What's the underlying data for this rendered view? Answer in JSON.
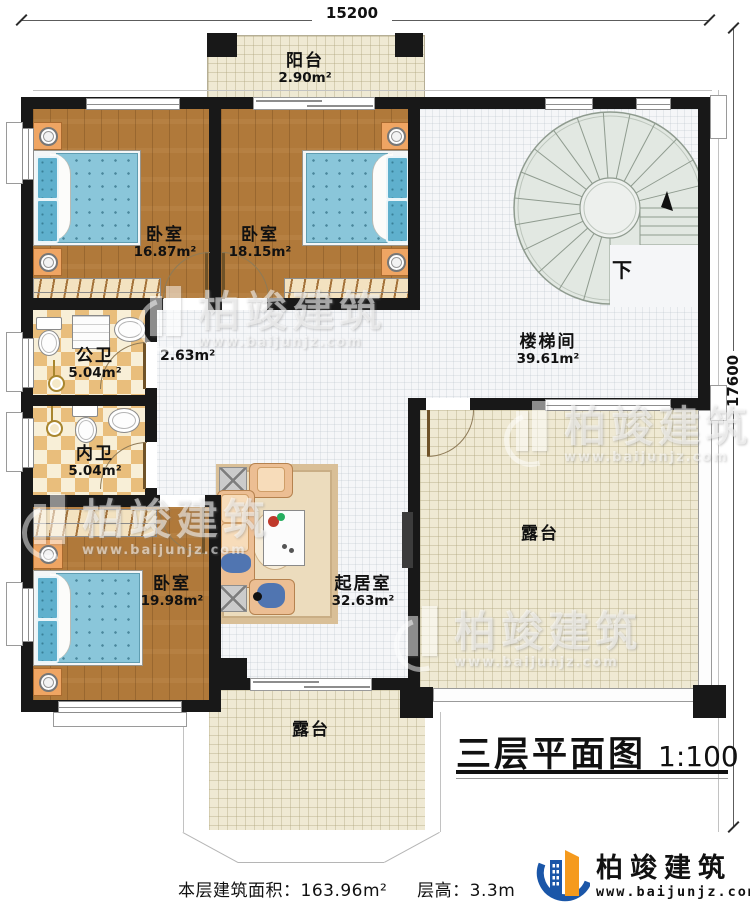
{
  "dimensions": {
    "top": "15200",
    "right": "17600"
  },
  "rooms": [
    {
      "name": "阳台",
      "area": "2.90m²"
    },
    {
      "name": "卧室",
      "area": "16.87m²"
    },
    {
      "name": "卧室",
      "area": "18.15m²"
    },
    {
      "name": "楼梯间",
      "area": "39.61m²"
    },
    {
      "name": "",
      "area": "2.63m²"
    },
    {
      "name": "公卫",
      "area": "5.04m²"
    },
    {
      "name": "内卫",
      "area": "5.04m²"
    },
    {
      "name": "卧室",
      "area": "19.98m²"
    },
    {
      "name": "起居室",
      "area": "32.63m²"
    },
    {
      "name": "露台",
      "area": ""
    },
    {
      "name": "露台",
      "area": ""
    }
  ],
  "stairs": {
    "down_label": "下"
  },
  "title": {
    "text": "三层平面图",
    "scale": "1:100"
  },
  "footer": {
    "area_label": "本层建筑面积：",
    "area_value": "163.96m²",
    "height_label": "层高：",
    "height_value": "3.3m"
  },
  "brand": {
    "company": "柏竣建筑",
    "website": "www.baijunjz.com",
    "blue": "#1a56a8",
    "orange": "#f59a1d"
  }
}
